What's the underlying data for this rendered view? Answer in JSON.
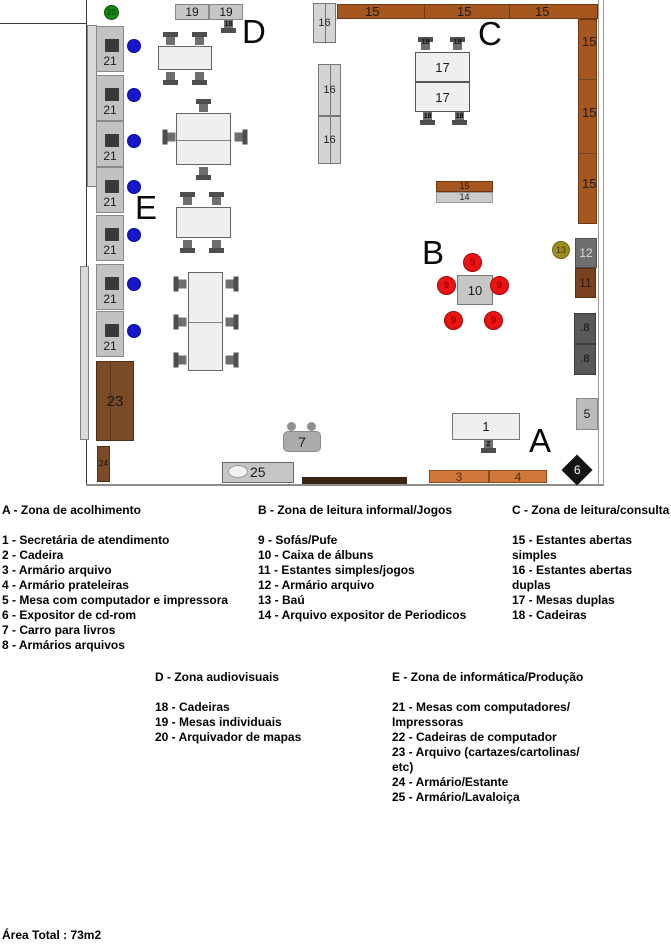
{
  "area_total": "Área Total : 73m2",
  "legend": {
    "zones": [
      {
        "heading": "A - Zona de acolhimento",
        "items": [
          "1 - Secretária de atendimento",
          "2 - Cadeira",
          "3 - Armário arquivo",
          "4 - Armário prateleiras",
          "5 - Mesa com computador e impressora",
          "6 - Expositor de cd-rom",
          "7 - Carro para livros",
          "8 - Armários arquivos"
        ]
      },
      {
        "heading": "B - Zona de leitura informal/Jogos",
        "items": [
          "9 - Sofás/Pufe",
          "10 - Caixa de álbuns",
          "11 - Estantes simples/jogos",
          "12 - Armário arquivo",
          "13 - Baú",
          "14 - Arquivo expositor de Periodicos"
        ]
      },
      {
        "heading": "C - Zona de leitura/consulta",
        "items": [
          "15 - Estantes abertas simples",
          "16 - Estantes abertas duplas",
          "17 - Mesas duplas",
          "18 - Cadeiras"
        ]
      },
      {
        "heading": "D - Zona audiovisuais",
        "items": [
          "18 - Cadeiras",
          "19 - Mesas individuais",
          "20 - Arquivador de mapas"
        ]
      },
      {
        "heading": "E - Zona de informática/Produção",
        "items": [
          "21 - Mesas com computadores/\nImpressoras",
          "22 - Cadeiras de computador",
          "23 - Arquivo (cartazes/cartolinas/\netc)",
          "24 - Armário/Estante",
          "25 - Armário/Lavaloiça"
        ]
      }
    ]
  },
  "plan": {
    "colors": {
      "shelf_brown": "#A5571E",
      "cabinet_gray": "#C2C2C2",
      "table_gray": "#EFEFEF",
      "sofa_red": "#EC1212",
      "chair_blue": "#1717D0",
      "arch_green": "#128A12",
      "bau_olive": "#9D8D1E",
      "wood_dark": "#7B4A26",
      "orange_cab": "#D0773B",
      "dark_box": "#595959"
    },
    "items": [
      {
        "t": "line",
        "n": "wall-left",
        "x": 86,
        "y": 0,
        "w": 1,
        "h": 486,
        "f": "#3a3a3a"
      },
      {
        "t": "line",
        "n": "wall-top-left-edge",
        "x": 0,
        "y": 23,
        "w": 87,
        "h": 1,
        "f": "#3a3a3a"
      },
      {
        "t": "rect",
        "n": "wall-strip-left-upper",
        "x": 87,
        "y": 25,
        "w": 10,
        "h": 162,
        "f": "#dadada",
        "s": "#808080"
      },
      {
        "t": "rect",
        "n": "wall-strip-left-lower",
        "x": 80,
        "y": 266,
        "w": 9,
        "h": 174,
        "f": "#dadada",
        "s": "#808080"
      },
      {
        "t": "line",
        "n": "wall-bottom",
        "x": 86,
        "y": 484,
        "w": 518,
        "h": 2,
        "f": "#8c8c8c"
      },
      {
        "t": "rect",
        "n": "wall-segment-dark",
        "x": 302,
        "y": 477,
        "w": 105,
        "h": 7,
        "f": "#3b2313"
      },
      {
        "t": "line",
        "n": "wall-right-inner",
        "x": 598,
        "y": 0,
        "w": 1,
        "h": 486,
        "f": "#9a9a9a"
      },
      {
        "t": "line",
        "n": "wall-right-outer",
        "x": 603,
        "y": 0,
        "w": 1,
        "h": 486,
        "f": "#9a9a9a"
      },
      {
        "t": "rect",
        "n": "shelf-16-top",
        "x": 313,
        "y": 3,
        "w": 23,
        "h": 40,
        "f": "#d4d4d4",
        "s": "#777",
        "vl": [
          11
        ],
        "l": "16",
        "ls": 11
      },
      {
        "t": "rect",
        "n": "shelf-15-top",
        "x": 337,
        "y": 4,
        "w": 261,
        "h": 15,
        "f": "#A5571E",
        "s": "#6e3812",
        "vl": [
          86,
          171
        ]
      },
      {
        "t": "tx",
        "n": "shelf-15-label",
        "x": 365,
        "y": 5,
        "txt": "15",
        "fs": 13
      },
      {
        "t": "tx",
        "n": "shelf-15-label",
        "x": 457,
        "y": 5,
        "txt": "15",
        "fs": 13
      },
      {
        "t": "tx",
        "n": "shelf-15-label",
        "x": 535,
        "y": 5,
        "txt": "15",
        "fs": 13
      },
      {
        "t": "rect",
        "n": "shelf-15-right",
        "x": 578,
        "y": 19,
        "w": 19,
        "h": 205,
        "f": "#A5571E",
        "s": "#6e3812",
        "hl": [
          59,
          133
        ]
      },
      {
        "t": "tx",
        "n": "shelf-15-label",
        "x": 582,
        "y": 35,
        "txt": "15",
        "fs": 13
      },
      {
        "t": "tx",
        "n": "shelf-15-label",
        "x": 582,
        "y": 106,
        "txt": "15",
        "fs": 13
      },
      {
        "t": "tx",
        "n": "shelf-15-label",
        "x": 582,
        "y": 177,
        "txt": "15",
        "fs": 13
      },
      {
        "t": "rect",
        "n": "shelf-16-double-upper",
        "x": 318,
        "y": 64,
        "w": 23,
        "h": 52,
        "f": "#d4d4d4",
        "s": "#777",
        "vl": [
          11
        ],
        "l": "16",
        "ls": 11
      },
      {
        "t": "rect",
        "n": "shelf-16-double-lower",
        "x": 318,
        "y": 116,
        "w": 23,
        "h": 48,
        "f": "#d4d4d4",
        "s": "#777",
        "vl": [
          11
        ],
        "l": "16",
        "ls": 11
      },
      {
        "t": "lt",
        "n": "zone-letter-c",
        "x": 478,
        "y": 17,
        "txt": "C"
      },
      {
        "t": "rect",
        "n": "table-17-upper",
        "x": 415,
        "y": 52,
        "w": 55,
        "h": 30,
        "f": "#EFEFEF",
        "s": "#555",
        "l": "17",
        "ls": 13
      },
      {
        "t": "rect",
        "n": "table-17-lower",
        "x": 415,
        "y": 82,
        "w": 55,
        "h": 30,
        "f": "#EFEFEF",
        "s": "#555",
        "l": "17",
        "ls": 13
      },
      {
        "t": "ch",
        "n": "chair-18",
        "x": 418,
        "y": 37,
        "r": 0,
        "l": "18"
      },
      {
        "t": "ch",
        "n": "chair-18",
        "x": 450,
        "y": 37,
        "r": 0,
        "l": "18"
      },
      {
        "t": "ch",
        "n": "chair-18",
        "x": 420,
        "y": 111,
        "r": 180,
        "l": "18"
      },
      {
        "t": "ch",
        "n": "chair-18",
        "x": 452,
        "y": 111,
        "r": 180,
        "l": "18"
      },
      {
        "t": "lt",
        "n": "zone-letter-d",
        "x": 242,
        "y": 15,
        "txt": "D"
      },
      {
        "t": "rect",
        "n": "table-19",
        "x": 175,
        "y": 4,
        "w": 34,
        "h": 16,
        "f": "#c6c6c6",
        "s": "#888",
        "l": "19",
        "ls": 12
      },
      {
        "t": "rect",
        "n": "table-19",
        "x": 209,
        "y": 4,
        "w": 34,
        "h": 16,
        "f": "#c6c6c6",
        "s": "#888",
        "l": "19",
        "ls": 12
      },
      {
        "t": "ch",
        "n": "chair-18",
        "x": 221,
        "y": 19,
        "r": 180,
        "l": "18"
      },
      {
        "t": "c",
        "n": "map-archive-20",
        "x": 104,
        "y": 5,
        "w": 15,
        "f": "#128A12",
        "s": "#0a4a0a",
        "l": "20",
        "ls": 8,
        "lc": "#04320a"
      },
      {
        "t": "rect",
        "n": "table-individual",
        "x": 158,
        "y": 46,
        "w": 54,
        "h": 24,
        "f": "#EFEFEF",
        "s": "#666"
      },
      {
        "t": "ch",
        "n": "chair",
        "x": 163,
        "y": 32,
        "r": 0
      },
      {
        "t": "ch",
        "n": "chair",
        "x": 192,
        "y": 32,
        "r": 0
      },
      {
        "t": "ch",
        "n": "chair",
        "x": 163,
        "y": 71,
        "r": 180
      },
      {
        "t": "ch",
        "n": "chair",
        "x": 192,
        "y": 71,
        "r": 180
      },
      {
        "t": "rect",
        "n": "table-double",
        "x": 176,
        "y": 113,
        "w": 55,
        "h": 52,
        "f": "#EFEFEF",
        "s": "#666",
        "hl": [
          26
        ]
      },
      {
        "t": "ch",
        "n": "chair",
        "x": 196,
        "y": 99,
        "r": 0
      },
      {
        "t": "ch",
        "n": "chair",
        "x": 162,
        "y": 130,
        "r": 270
      },
      {
        "t": "ch",
        "n": "chair",
        "x": 233,
        "y": 130,
        "r": 90
      },
      {
        "t": "ch",
        "n": "chair",
        "x": 196,
        "y": 166,
        "r": 180
      },
      {
        "t": "lt",
        "n": "zone-letter-e",
        "x": 135,
        "y": 191,
        "txt": "E"
      },
      {
        "t": "rect",
        "n": "table-individual",
        "x": 176,
        "y": 207,
        "w": 55,
        "h": 31,
        "f": "#EFEFEF",
        "s": "#666"
      },
      {
        "t": "ch",
        "n": "chair",
        "x": 180,
        "y": 192,
        "r": 0
      },
      {
        "t": "ch",
        "n": "chair",
        "x": 209,
        "y": 192,
        "r": 0
      },
      {
        "t": "ch",
        "n": "chair",
        "x": 180,
        "y": 239,
        "r": 180
      },
      {
        "t": "ch",
        "n": "chair",
        "x": 209,
        "y": 239,
        "r": 180
      },
      {
        "t": "rect",
        "n": "table-double",
        "x": 188,
        "y": 272,
        "w": 35,
        "h": 99,
        "f": "#EFEFEF",
        "s": "#666",
        "hl": [
          49
        ]
      },
      {
        "t": "ch",
        "n": "chair",
        "x": 173,
        "y": 277,
        "r": 270
      },
      {
        "t": "ch",
        "n": "chair",
        "x": 173,
        "y": 315,
        "r": 270
      },
      {
        "t": "ch",
        "n": "chair",
        "x": 173,
        "y": 353,
        "r": 270
      },
      {
        "t": "ch",
        "n": "chair",
        "x": 224,
        "y": 277,
        "r": 90
      },
      {
        "t": "ch",
        "n": "chair",
        "x": 224,
        "y": 315,
        "r": 90
      },
      {
        "t": "ch",
        "n": "chair",
        "x": 224,
        "y": 353,
        "r": 90
      },
      {
        "t": "cab",
        "n": "computer-desk-21",
        "x": 96,
        "y": 26
      },
      {
        "t": "cab",
        "n": "computer-desk-21",
        "x": 96,
        "y": 75
      },
      {
        "t": "cab",
        "n": "computer-desk-21",
        "x": 96,
        "y": 121
      },
      {
        "t": "cab",
        "n": "computer-desk-21",
        "x": 96,
        "y": 167
      },
      {
        "t": "cab",
        "n": "computer-desk-21",
        "x": 96,
        "y": 215
      },
      {
        "t": "cab",
        "n": "computer-desk-21",
        "x": 96,
        "y": 264
      },
      {
        "t": "cab",
        "n": "computer-desk-21",
        "x": 96,
        "y": 311
      },
      {
        "t": "c",
        "n": "computer-chair-22",
        "x": 127,
        "y": 39,
        "w": 14,
        "f": "#1717D0",
        "s": "#0a0a8a"
      },
      {
        "t": "c",
        "n": "computer-chair-22",
        "x": 127,
        "y": 88,
        "w": 14,
        "f": "#1717D0",
        "s": "#0a0a8a"
      },
      {
        "t": "c",
        "n": "computer-chair-22",
        "x": 127,
        "y": 134,
        "w": 14,
        "f": "#1717D0",
        "s": "#0a0a8a"
      },
      {
        "t": "c",
        "n": "computer-chair-22",
        "x": 127,
        "y": 180,
        "w": 14,
        "f": "#1717D0",
        "s": "#0a0a8a"
      },
      {
        "t": "c",
        "n": "computer-chair-22",
        "x": 127,
        "y": 228,
        "w": 14,
        "f": "#1717D0",
        "s": "#0a0a8a"
      },
      {
        "t": "c",
        "n": "computer-chair-22",
        "x": 127,
        "y": 277,
        "w": 14,
        "f": "#1717D0",
        "s": "#0a0a8a"
      },
      {
        "t": "c",
        "n": "computer-chair-22",
        "x": 127,
        "y": 324,
        "w": 14,
        "f": "#1717D0",
        "s": "#0a0a8a"
      },
      {
        "t": "rect",
        "n": "archive-23",
        "x": 96,
        "y": 361,
        "w": 38,
        "h": 80,
        "f": "#7B4A26",
        "s": "#4f2f18",
        "vl": [
          13
        ],
        "l": "23",
        "ls": 15,
        "lc": "#1a1a1a"
      },
      {
        "t": "rect",
        "n": "cabinet-24",
        "x": 97,
        "y": 446,
        "w": 13,
        "h": 36,
        "f": "#7B4A26",
        "s": "#4f2f18",
        "l": "24",
        "ls": 8,
        "lc": "#111"
      },
      {
        "t": "rect",
        "n": "sink-cabinet-25",
        "x": 222,
        "y": 462,
        "w": 72,
        "h": 21,
        "f": "#c6c6c6",
        "s": "#666"
      },
      {
        "t": "c",
        "n": "sink-basin",
        "x": 228,
        "y": 465,
        "w": 20,
        "h": 13,
        "f": "#f2f2f2",
        "s": "#999"
      },
      {
        "t": "tx",
        "n": "sink-cabinet-25-label",
        "x": 250,
        "y": 465,
        "txt": "25",
        "fs": 14
      },
      {
        "t": "c",
        "n": "book-cart-wheel",
        "x": 287,
        "y": 422,
        "w": 9,
        "f": "#909090"
      },
      {
        "t": "c",
        "n": "book-cart-wheel",
        "x": 307,
        "y": 422,
        "w": 9,
        "f": "#909090"
      },
      {
        "t": "rect",
        "n": "book-cart-7",
        "x": 283,
        "y": 431,
        "w": 38,
        "h": 21,
        "f": "#ababab",
        "s": "#8a8a8a",
        "rd": 5,
        "l": "7",
        "ls": 14
      },
      {
        "t": "lt",
        "n": "zone-letter-a",
        "x": 529,
        "y": 424,
        "txt": "A"
      },
      {
        "t": "rect",
        "n": "reception-desk-1",
        "x": 452,
        "y": 413,
        "w": 68,
        "h": 27,
        "f": "#EFEFEF",
        "s": "#777",
        "l": "1",
        "ls": 13
      },
      {
        "t": "ch",
        "n": "chair-2",
        "x": 481,
        "y": 439,
        "r": 180,
        "l": "2"
      },
      {
        "t": "rect",
        "n": "archive-3",
        "x": 429,
        "y": 470,
        "w": 60,
        "h": 13,
        "f": "#D0773B",
        "s": "#8a4a1a",
        "l": "3",
        "ls": 12,
        "lc": "#5a2a08"
      },
      {
        "t": "rect",
        "n": "shelf-cabinet-4",
        "x": 489,
        "y": 470,
        "w": 58,
        "h": 13,
        "f": "#D0773B",
        "s": "#8a4a1a",
        "l": "4",
        "ls": 12,
        "lc": "#5a2a08"
      },
      {
        "t": "dm",
        "n": "cdrom-display-6",
        "x": 566,
        "y": 459,
        "w": 22,
        "l": "6"
      },
      {
        "t": "lt",
        "n": "zone-letter-b",
        "x": 422,
        "y": 236,
        "txt": "B"
      },
      {
        "t": "rect",
        "n": "album-box-10",
        "x": 457,
        "y": 275,
        "w": 36,
        "h": 30,
        "f": "#c6c6c6",
        "s": "#777",
        "xb": 1,
        "l": "10",
        "ls": 13
      },
      {
        "t": "c",
        "n": "sofa-9",
        "x": 463,
        "y": 253,
        "w": 19,
        "f": "#EC1212",
        "s": "#990b0b",
        "l": "9",
        "ls": 9,
        "lc": "#6b0000"
      },
      {
        "t": "c",
        "n": "sofa-9",
        "x": 437,
        "y": 276,
        "w": 19,
        "f": "#EC1212",
        "s": "#990b0b",
        "l": "9",
        "ls": 9,
        "lc": "#6b0000"
      },
      {
        "t": "c",
        "n": "sofa-9",
        "x": 490,
        "y": 276,
        "w": 19,
        "f": "#EC1212",
        "s": "#990b0b",
        "l": "9",
        "ls": 9,
        "lc": "#6b0000"
      },
      {
        "t": "c",
        "n": "sofa-9",
        "x": 444,
        "y": 311,
        "w": 19,
        "f": "#EC1212",
        "s": "#990b0b",
        "l": "9",
        "ls": 9,
        "lc": "#6b0000"
      },
      {
        "t": "c",
        "n": "sofa-9",
        "x": 484,
        "y": 311,
        "w": 19,
        "f": "#EC1212",
        "s": "#990b0b",
        "l": "9",
        "ls": 9,
        "lc": "#6b0000"
      },
      {
        "t": "c",
        "n": "bau-13",
        "x": 552,
        "y": 241,
        "w": 18,
        "f": "#9D8D1E",
        "s": "#6f6414",
        "l": "13",
        "ls": 9,
        "lc": "#3f3708"
      },
      {
        "t": "rect",
        "n": "archive-12",
        "x": 575,
        "y": 238,
        "w": 22,
        "h": 30,
        "f": "#6f6f6f",
        "s": "#4f4f4f",
        "l": "12",
        "ls": 12,
        "lc": "#dcdcdc"
      },
      {
        "t": "rect",
        "n": "games-shelf-11",
        "x": 575,
        "y": 268,
        "w": 21,
        "h": 30,
        "f": "#7A431F",
        "s": "#542c10",
        "l": "11",
        "ls": 12,
        "lc": "#2f1708"
      },
      {
        "t": "rect",
        "n": "archive-8",
        "x": 574,
        "y": 313,
        "w": 22,
        "h": 31,
        "f": "#595959",
        "s": "#3c3c3c",
        "l": ".8",
        "ls": 11,
        "lc": "#0f0f0f"
      },
      {
        "t": "rect",
        "n": "archive-8",
        "x": 574,
        "y": 344,
        "w": 22,
        "h": 31,
        "f": "#595959",
        "s": "#3c3c3c",
        "l": ".8",
        "ls": 11,
        "lc": "#0f0f0f"
      },
      {
        "t": "rect",
        "n": "computer-table-5",
        "x": 576,
        "y": 398,
        "w": 22,
        "h": 32,
        "f": "#bbbbbb",
        "s": "#8a8a8a",
        "l": "5",
        "ls": 12,
        "lc": "#1a1a1a"
      },
      {
        "t": "rect",
        "n": "periodicals-15",
        "x": 436,
        "y": 181,
        "w": 57,
        "h": 11,
        "f": "#A5571E",
        "s": "#6e3812",
        "l": "15",
        "ls": 9,
        "lc": "#2a1000"
      },
      {
        "t": "rect",
        "n": "periodicals-14",
        "x": 436,
        "y": 192,
        "w": 57,
        "h": 11,
        "f": "#cbcbcb",
        "s": "#999",
        "l": "14",
        "ls": 9,
        "lc": "#222"
      }
    ]
  }
}
